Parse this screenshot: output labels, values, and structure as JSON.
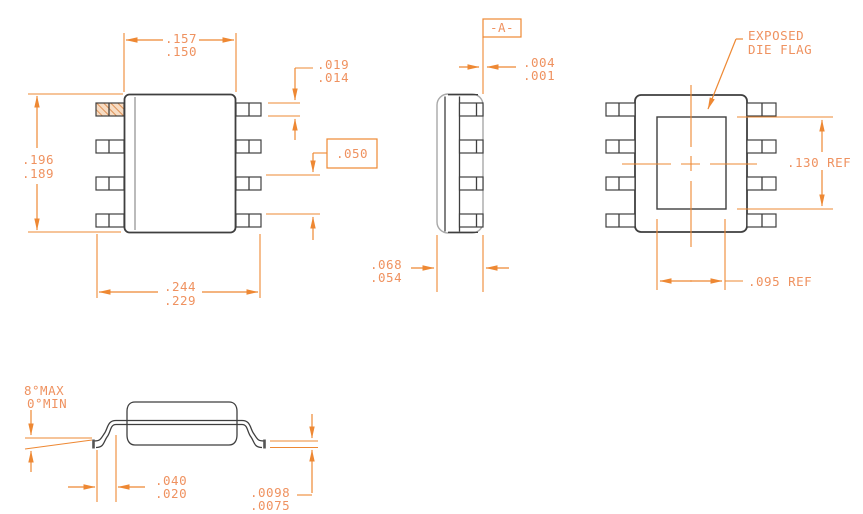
{
  "colors": {
    "dimension_line": "#ee8833",
    "dimension_text": "#ef9260",
    "drawing_line": "#3f3f3f",
    "hatch_fill": "#f7dcc3"
  },
  "top_view": {
    "body_width_max": ".157",
    "body_width_min": ".150",
    "body_len_max": ".196",
    "body_len_min": ".189",
    "span_max": ".244",
    "span_min": ".229",
    "lead_w_max": ".019",
    "lead_w_min": ".014",
    "pitch": ".050"
  },
  "side_view": {
    "datum": "-A-",
    "standoff_max": ".004",
    "standoff_min": ".001",
    "height_max": ".068",
    "height_min": ".054"
  },
  "bottom_view": {
    "flag_label_1": "EXPOSED",
    "flag_label_2": "DIE FLAG",
    "flag_len": ".130 REF",
    "flag_w": ".095 REF"
  },
  "profile_view": {
    "angle_max": "8°MAX",
    "angle_min": "0°MIN",
    "foot_max": ".040",
    "foot_min": ".020",
    "thick_max": ".0098",
    "thick_min": ".0075"
  }
}
